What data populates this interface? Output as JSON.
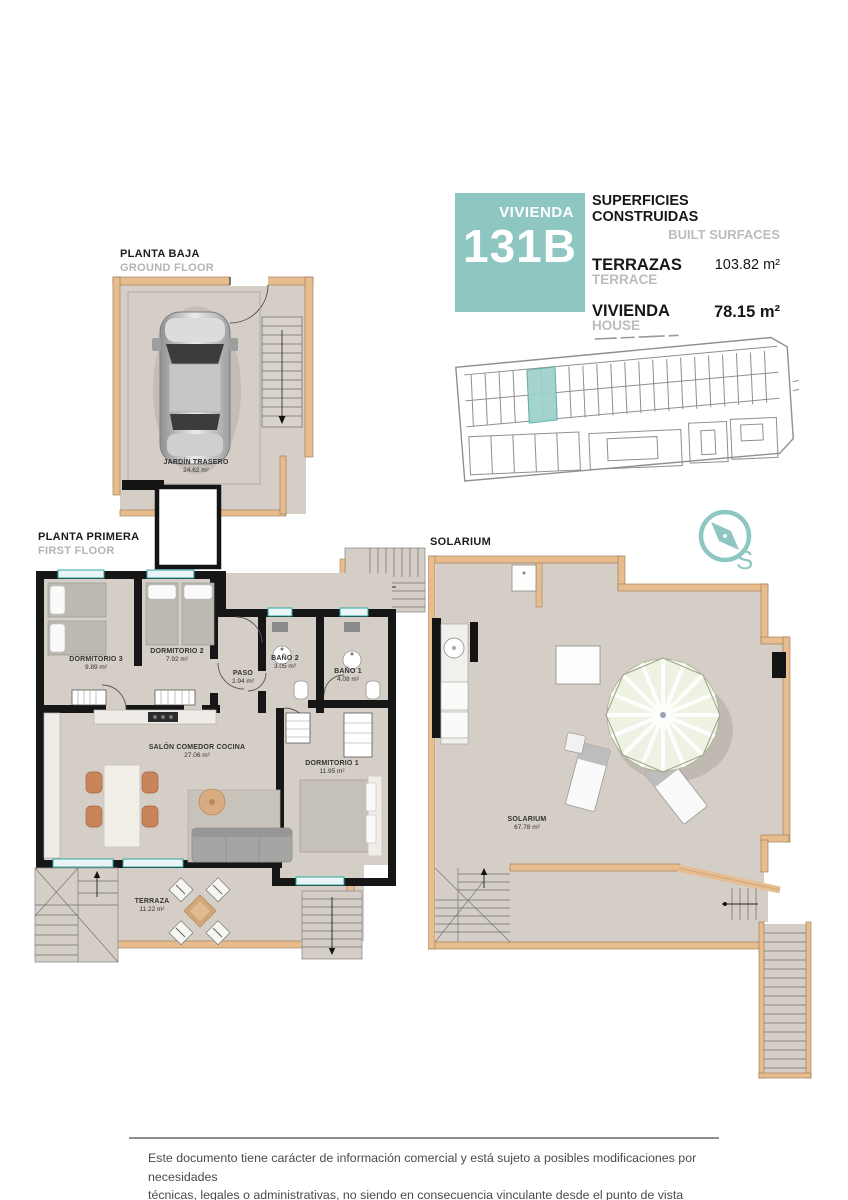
{
  "unit_card": {
    "unit_label": "VIVIENDA",
    "unit_number": "131B",
    "surfaces_title_es": "SUPERFICIES CONSTRUIDAS",
    "surfaces_title_en": "BUILT SURFACES",
    "rows": [
      {
        "label_es": "TERRAZAS",
        "label_en": "TERRACE",
        "value": "103.82 m²"
      },
      {
        "label_es": "VIVIENDA",
        "label_en": "HOUSE",
        "value": "78.15 m²"
      }
    ]
  },
  "compass": {
    "letter": "S"
  },
  "plans": {
    "ground_floor": {
      "title_es": "PLANTA BAJA",
      "title_en": "GROUND FLOOR",
      "rooms": [
        {
          "name": "JARDÍN TRASERO",
          "area": "24.62 m²"
        }
      ]
    },
    "first_floor": {
      "title_es": "PLANTA PRIMERA",
      "title_en": "FIRST FLOOR",
      "rooms": [
        {
          "name": "DORMITORIO 3",
          "area": "9.89 m²"
        },
        {
          "name": "DORMITORIO 2",
          "area": "7.92 m²"
        },
        {
          "name": "PASO",
          "area": "2.94 m²"
        },
        {
          "name": "BAÑO 2",
          "area": "3.05 m²"
        },
        {
          "name": "BAÑO 1",
          "area": "4.08 m²"
        },
        {
          "name": "SALÓN COMEDOR COCINA",
          "area": "27.06 m²"
        },
        {
          "name": "DORMITORIO 1",
          "area": "11.95 m²"
        },
        {
          "name": "TERRAZA",
          "area": "11.22 m²"
        }
      ]
    },
    "solarium": {
      "title_es": "SOLARIUM",
      "rooms": [
        {
          "name": "SOLARIUM",
          "area": "67.78 m²"
        }
      ]
    }
  },
  "footer": {
    "disclaimer_line1": "Este documento tiene carácter de información comercial y está sujeto a posibles modificaciones por necesidades",
    "disclaimer_line2": "técnicas, legales o administrativas, no siendo en consecuencia vinculante desde el punto de vista contractual."
  },
  "colors": {
    "accent_teal": "#8ec7c2",
    "window_teal": "#2fa8a1",
    "wall_black": "#161616",
    "wall_tan": "#e7bd90",
    "floor_beige": "#d5cec6",
    "text_gray": "#bcbcbc"
  }
}
